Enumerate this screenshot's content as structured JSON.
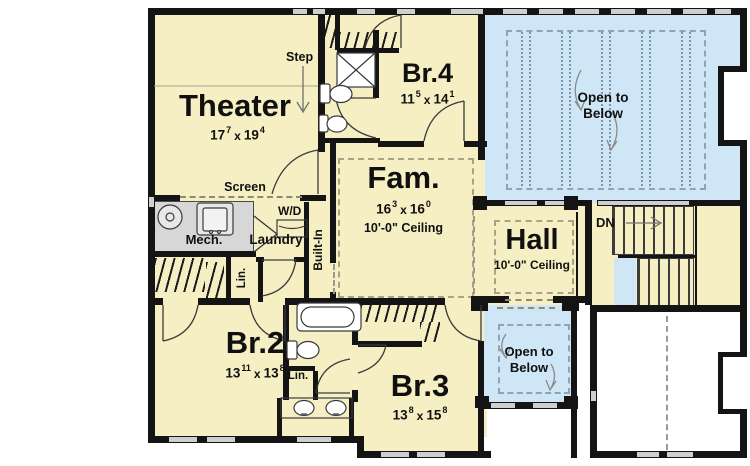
{
  "plan": {
    "rooms": {
      "theater": {
        "name": "Theater",
        "dim_a": "17",
        "dim_a_sup": "7",
        "dim_x": "x",
        "dim_b": "19",
        "dim_b_sup": "4"
      },
      "br4": {
        "name": "Br.4",
        "dim_a": "11",
        "dim_a_sup": "5",
        "dim_x": "x",
        "dim_b": "14",
        "dim_b_sup": "1"
      },
      "fam": {
        "name": "Fam.",
        "dim_a": "16",
        "dim_a_sup": "3",
        "dim_x": "x",
        "dim_b": "16",
        "dim_b_sup": "0",
        "ceiling": "10'-0\" Ceiling"
      },
      "hall": {
        "name": "Hall",
        "ceiling": "10'-0\" Ceiling"
      },
      "br2": {
        "name": "Br.2",
        "dim_a": "13",
        "dim_a_sup": "11",
        "dim_x": "x",
        "dim_b": "13",
        "dim_b_sup": "8"
      },
      "br3": {
        "name": "Br.3",
        "dim_a": "13",
        "dim_a_sup": "8",
        "dim_x": "x",
        "dim_b": "15",
        "dim_b_sup": "8"
      },
      "mech": {
        "name": "Mech."
      },
      "laundry": {
        "name": "Laundry"
      }
    },
    "annotations": {
      "step": "Step",
      "screen": "Screen",
      "wd": "W/D",
      "built_in": "Built-In",
      "lin_upper": "Lin.",
      "lin_lower": "Lin.",
      "dn": "DN",
      "open_below_upper_1": "Open to",
      "open_below_upper_2": "Below",
      "open_below_lower_1": "Open to",
      "open_below_lower_2": "Below"
    },
    "colors": {
      "room": "#f6efc3",
      "open_to_below": "#cfe6f7",
      "mech_room": "#d7d7d7",
      "wall": "#141414",
      "window": "#cfcfcf"
    }
  }
}
